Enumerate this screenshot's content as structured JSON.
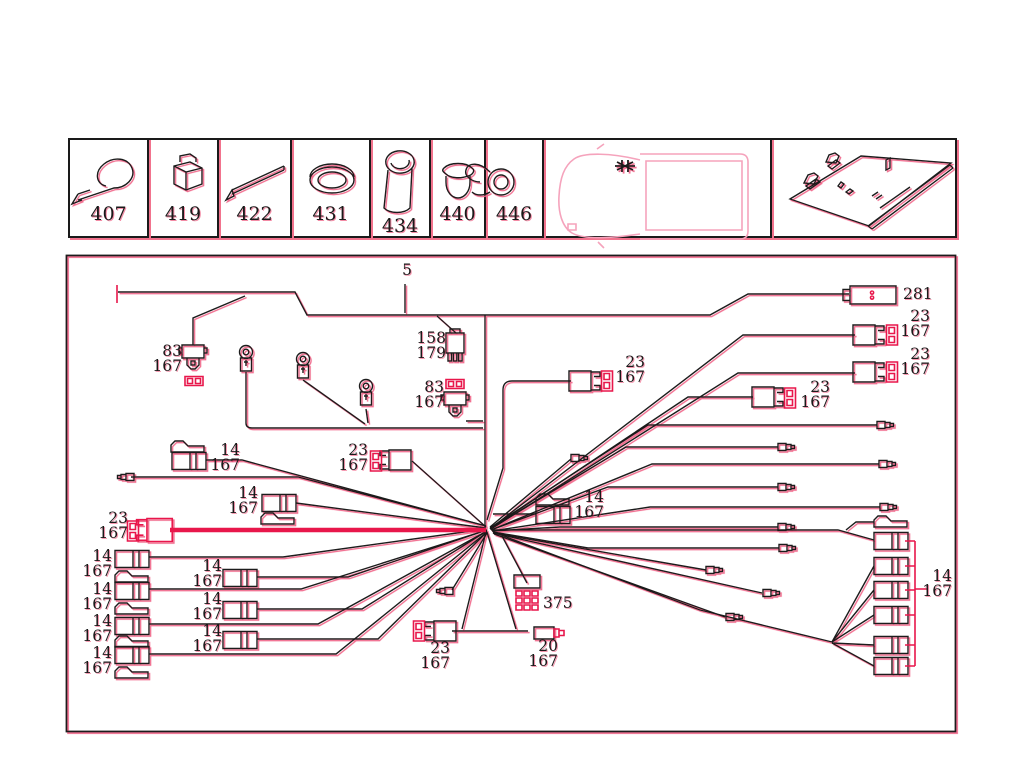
{
  "colors": {
    "ink": "#1a1a1a",
    "red": "#e8174b",
    "red_fringe": "#f2738d",
    "pink": "#f5a3bc"
  },
  "legend": {
    "cells": [
      {
        "part": "407",
        "icon": "cable-tie-icon",
        "w": 79
      },
      {
        "part": "419",
        "icon": "retaining-clip-icon",
        "w": 70
      },
      {
        "part": "422",
        "icon": "protective-sleeve-icon",
        "w": 73
      },
      {
        "part": "431",
        "icon": "grommet-icon",
        "w": 79
      },
      {
        "part": "434",
        "icon": "rubber-boot-icon",
        "w": 60,
        "drop": true
      },
      {
        "part": "440",
        "icon": "blanking-plug-icon",
        "w": 55
      },
      {
        "part": "446",
        "icon": "cable-clamp-icon",
        "w": 58
      },
      {
        "part": "",
        "icon": "vehicle-top-view",
        "w": 228
      },
      {
        "part": "",
        "icon": "harness-overview",
        "w": 183
      }
    ]
  },
  "diagram": {
    "callouts": [
      {
        "l": [
          "5"
        ],
        "r": 412,
        "t": 263
      },
      {
        "l": [
          "281"
        ],
        "x": 903,
        "t": 287
      },
      {
        "l": [
          "23",
          "167"
        ],
        "r": 930,
        "t": 309
      },
      {
        "l": [
          "23",
          "167"
        ],
        "r": 930,
        "t": 347
      },
      {
        "l": [
          "23",
          "167"
        ],
        "r": 830,
        "t": 380
      },
      {
        "l": [
          "23",
          "167"
        ],
        "r": 645,
        "t": 355
      },
      {
        "l": [
          "158",
          "179"
        ],
        "r": 446,
        "t": 331
      },
      {
        "l": [
          "83",
          "167"
        ],
        "r": 182,
        "t": 344
      },
      {
        "l": [
          "83",
          "167"
        ],
        "r": 444,
        "t": 380
      },
      {
        "l": [
          "23",
          "167"
        ],
        "r": 368,
        "t": 443
      },
      {
        "l": [
          "14",
          "167"
        ],
        "r": 240,
        "t": 443
      },
      {
        "l": [
          "14",
          "167"
        ],
        "r": 258,
        "t": 486
      },
      {
        "l": [
          "23",
          "167"
        ],
        "r": 128,
        "t": 511
      },
      {
        "l": [
          "14",
          "167"
        ],
        "r": 604,
        "t": 490
      },
      {
        "l": [
          "14",
          "167"
        ],
        "r": 112,
        "t": 549
      },
      {
        "l": [
          "14",
          "167"
        ],
        "r": 112,
        "t": 582
      },
      {
        "l": [
          "14",
          "167"
        ],
        "r": 112,
        "t": 614
      },
      {
        "l": [
          "14",
          "167"
        ],
        "r": 112,
        "t": 646
      },
      {
        "l": [
          "14",
          "167"
        ],
        "r": 222,
        "t": 559
      },
      {
        "l": [
          "14",
          "167"
        ],
        "r": 222,
        "t": 592
      },
      {
        "l": [
          "14",
          "167"
        ],
        "r": 222,
        "t": 624
      },
      {
        "l": [
          "14",
          "167"
        ],
        "r": 952,
        "t": 569
      },
      {
        "l": [
          "375"
        ],
        "x": 543,
        "t": 596
      },
      {
        "l": [
          "23",
          "167"
        ],
        "r": 450,
        "t": 641
      },
      {
        "l": [
          "20",
          "167"
        ],
        "r": 558,
        "t": 639
      }
    ],
    "wires": [
      {
        "d": "M118,292 H295 L307,315 H710 L748,294 H849"
      },
      {
        "d": "M117,285 V303",
        "s": "red"
      },
      {
        "d": "M405,284 V313"
      },
      {
        "d": "M485,315 V527"
      },
      {
        "d": "M193,345 V318 L245,296"
      },
      {
        "d": "M437,316 L456,333"
      },
      {
        "d": "M466,421 H483"
      },
      {
        "d": "M571,381 H512 Q503,381 503,390 V468 L487,520"
      },
      {
        "d": "M246,372 V423 Q246,428 252,428 H483"
      },
      {
        "d": "M303,380 L365,424"
      },
      {
        "d": "M366,409 L368,423"
      },
      {
        "d": "M855,335 H743 L491,528"
      },
      {
        "d": "M855,373 H738 L491,529"
      },
      {
        "d": "M753,397 H688 L490,529"
      },
      {
        "d": "M877,425 H648 L490,528"
      },
      {
        "d": "M778,447 H626 L490,529"
      },
      {
        "d": "M879,464 H652 L491,530"
      },
      {
        "d": "M778,487 H608 L491,530"
      },
      {
        "d": "M880,507 H650 L492,531"
      },
      {
        "d": "M778,527 H560 L492,531"
      },
      {
        "d": "M779,548 H588 L493,532"
      },
      {
        "d": "M706,570 L493,533"
      },
      {
        "d": "M762,593 L493,533"
      },
      {
        "d": "M725,617 L494,534"
      },
      {
        "d": "M492,530 H838 L874,540"
      },
      {
        "d": "M874,522 H856 L846,530"
      },
      {
        "d": "M493,532 L700,610 L832,642"
      },
      {
        "d": "M832,642 L874,566"
      },
      {
        "d": "M832,642 L874,590"
      },
      {
        "d": "M832,642 L874,615"
      },
      {
        "d": "M832,643 L874,645"
      },
      {
        "d": "M832,643 L874,666"
      },
      {
        "d": "M905,541 H915 M905,566 H915 M905,590 H915 M905,615 H915 M905,645 H915 M905,666 H915 M915,541 V666 M915,589 H928",
        "s": "red"
      },
      {
        "d": "M170,530 H486",
        "s": "redthick"
      },
      {
        "d": "M131,477 H298 L486,526"
      },
      {
        "d": "M206,460 H242 L486,526"
      },
      {
        "d": "M296,503 L486,528"
      },
      {
        "d": "M536,514 H493"
      },
      {
        "d": "M412,461 L486,527"
      },
      {
        "d": "M452,590 L487,533"
      },
      {
        "d": "M571,459 L490,527"
      },
      {
        "d": "M149,557 H283 L486,529"
      },
      {
        "d": "M149,589 H301 L487,530"
      },
      {
        "d": "M149,624 H318 L487,531"
      },
      {
        "d": "M149,654 H336 L487,532"
      },
      {
        "d": "M257,577 H348 L487,530"
      },
      {
        "d": "M257,609 H362 L487,531"
      },
      {
        "d": "M257,639 H378 L487,532"
      },
      {
        "d": "M452,631 H528 M486,532 L462,629 M487,532 L516,629"
      },
      {
        "d": "M527,583 L502,536"
      }
    ],
    "connectors": [
      {
        "t": "conn281",
        "x": 873,
        "y": 295,
        "n": "connector-281"
      },
      {
        "t": "conn23",
        "x": 868,
        "y": 335
      },
      {
        "t": "fuse2v",
        "x": 892,
        "y": 335
      },
      {
        "t": "conn23",
        "x": 868,
        "y": 372
      },
      {
        "t": "fuse2v",
        "x": 892,
        "y": 372
      },
      {
        "t": "conn23",
        "x": 767,
        "y": 397
      },
      {
        "t": "fuse2v",
        "x": 790,
        "y": 398
      },
      {
        "t": "conn23",
        "x": 584,
        "y": 381
      },
      {
        "t": "fuse2v",
        "x": 607,
        "y": 381
      },
      {
        "t": "conn23",
        "x": 396,
        "y": 460,
        "m": -1
      },
      {
        "t": "fuse2v",
        "x": 376,
        "y": 461
      },
      {
        "t": "conn23",
        "x": 155,
        "y": 530,
        "m": -1,
        "k": 1.15,
        "c": "red"
      },
      {
        "t": "fuse2v",
        "x": 133,
        "y": 531
      },
      {
        "t": "conn23",
        "x": 441,
        "y": 631,
        "m": -1
      },
      {
        "t": "fuse2v",
        "x": 419,
        "y": 631
      },
      {
        "t": "plug83",
        "x": 193,
        "y": 354,
        "n": "plug-connector-83"
      },
      {
        "t": "fuse2h",
        "x": 194,
        "y": 381
      },
      {
        "t": "plug83",
        "x": 455,
        "y": 401,
        "n": "plug-connector-83"
      },
      {
        "t": "fuse2h",
        "x": 455,
        "y": 384
      },
      {
        "t": "plug158",
        "x": 455,
        "y": 345,
        "n": "plug-connector-158"
      },
      {
        "t": "eyelet",
        "x": 246,
        "y": 360
      },
      {
        "t": "eyelet",
        "x": 303,
        "y": 367
      },
      {
        "t": "eyelet",
        "x": 366,
        "y": 394
      },
      {
        "t": "box375",
        "x": 527,
        "y": 597,
        "n": "multipin-block-375"
      },
      {
        "t": "conn20",
        "x": 546,
        "y": 633,
        "n": "connector-20"
      },
      {
        "t": "cyl",
        "x": 189,
        "y": 461
      },
      {
        "t": "flag",
        "x": 188,
        "y": 447
      },
      {
        "t": "cyl",
        "x": 279,
        "y": 503
      },
      {
        "t": "flag",
        "x": 278,
        "y": 519
      },
      {
        "t": "cyl",
        "x": 553,
        "y": 515
      },
      {
        "t": "flag",
        "x": 553,
        "y": 500
      },
      {
        "t": "cyl",
        "x": 132,
        "y": 559
      },
      {
        "t": "flag",
        "x": 132,
        "y": 577
      },
      {
        "t": "cyl",
        "x": 132,
        "y": 591
      },
      {
        "t": "flag",
        "x": 132,
        "y": 609
      },
      {
        "t": "cyl",
        "x": 132,
        "y": 626
      },
      {
        "t": "flag",
        "x": 132,
        "y": 642
      },
      {
        "t": "cyl",
        "x": 132,
        "y": 655
      },
      {
        "t": "flag",
        "x": 132,
        "y": 673
      },
      {
        "t": "cyl",
        "x": 240,
        "y": 578
      },
      {
        "t": "cyl",
        "x": 240,
        "y": 610
      },
      {
        "t": "cyl",
        "x": 240,
        "y": 640
      },
      {
        "t": "flag",
        "x": 891,
        "y": 522
      },
      {
        "t": "cyl",
        "x": 891,
        "y": 541
      },
      {
        "t": "cyl",
        "x": 891,
        "y": 566
      },
      {
        "t": "cyl",
        "x": 891,
        "y": 590
      },
      {
        "t": "cyl",
        "x": 891,
        "y": 615
      },
      {
        "t": "cyl",
        "x": 891,
        "y": 645
      },
      {
        "t": "cyl",
        "x": 891,
        "y": 666
      },
      {
        "t": "bullet",
        "x": 127,
        "y": 477,
        "m": -1
      },
      {
        "t": "bullet",
        "x": 446,
        "y": 591,
        "m": -1
      },
      {
        "t": "bullet",
        "x": 578,
        "y": 458
      },
      {
        "t": "bullet",
        "x": 884,
        "y": 425
      },
      {
        "t": "bullet",
        "x": 785,
        "y": 447
      },
      {
        "t": "bullet",
        "x": 886,
        "y": 464
      },
      {
        "t": "bullet",
        "x": 785,
        "y": 487
      },
      {
        "t": "bullet",
        "x": 887,
        "y": 507
      },
      {
        "t": "bullet",
        "x": 785,
        "y": 527
      },
      {
        "t": "bullet",
        "x": 786,
        "y": 548
      },
      {
        "t": "bullet",
        "x": 713,
        "y": 570
      },
      {
        "t": "bullet",
        "x": 770,
        "y": 593
      },
      {
        "t": "bullet",
        "x": 733,
        "y": 617
      }
    ]
  }
}
